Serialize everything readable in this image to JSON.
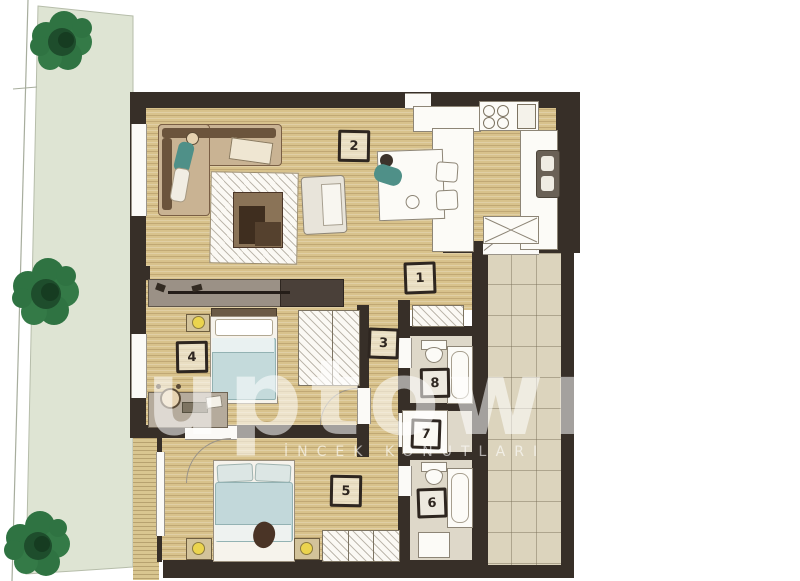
{
  "title": "apartment-floor-plan",
  "watermark": {
    "brand": "uptown",
    "subtitle": "İNCEK KONUTLARI"
  },
  "room_labels": [
    "1",
    "2",
    "3",
    "4",
    "5",
    "6",
    "7",
    "8"
  ],
  "palette": {
    "wall": "#372f28",
    "wood_floor": "#d8c28c",
    "terrace_tile": "#dcd4bd",
    "bath_floor": "#ded8c9",
    "garden": "#dee4d3",
    "tree": "#2f7342",
    "tree_core": "#1e4d2c",
    "lamp_yellow": "#ebd44e",
    "person_teal": "#4f9088",
    "blanket_blue": "#c4dadb"
  },
  "icons": [
    "tree-icon",
    "lamp-icon",
    "stove-icon",
    "sink-icon",
    "toilet-icon",
    "bathtub-icon",
    "shower-icon",
    "bed-icon",
    "sofa-icon",
    "pet-icon"
  ]
}
